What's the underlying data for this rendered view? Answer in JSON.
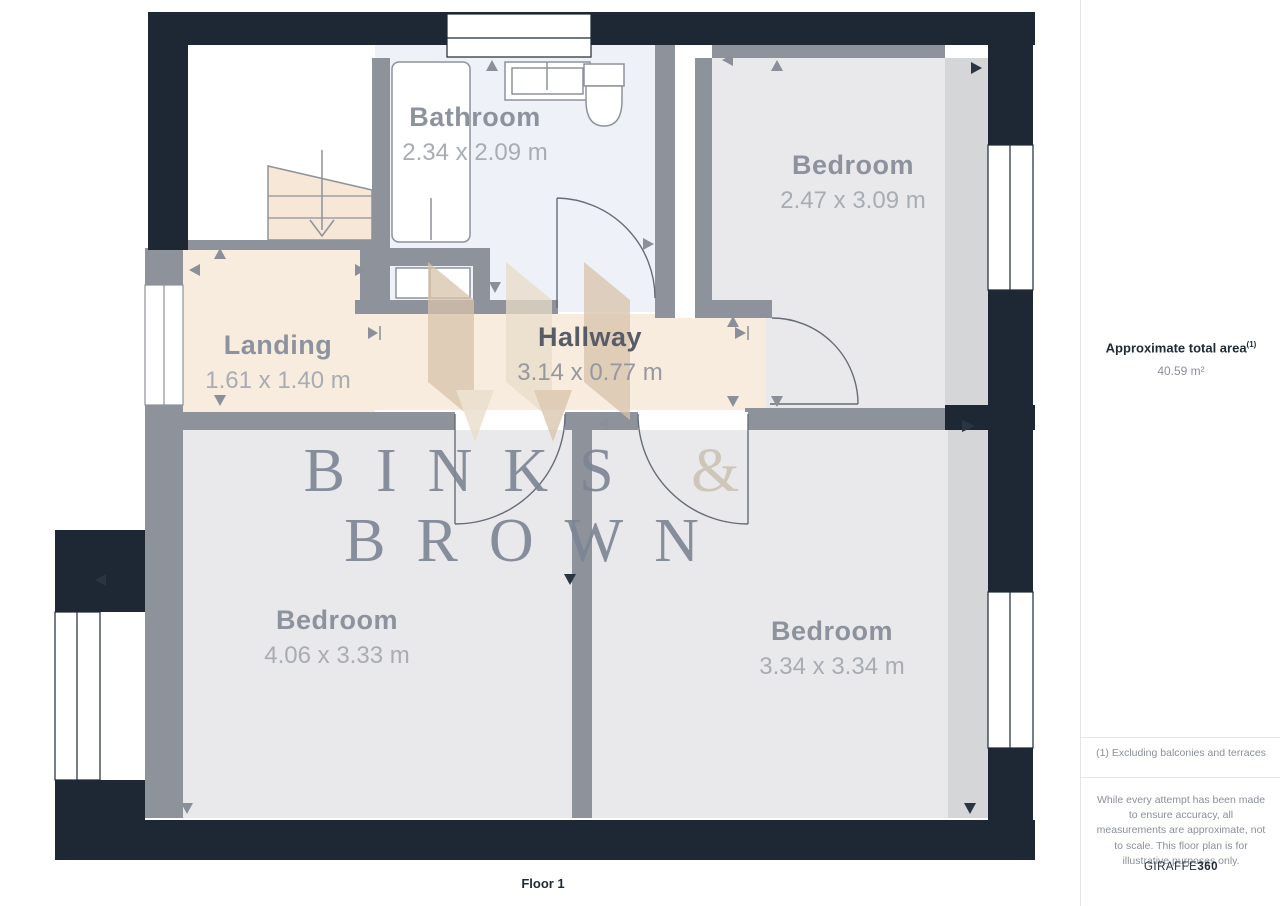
{
  "plan": {
    "floor_label": "Floor 1",
    "rooms": [
      {
        "name": "Bathroom",
        "dims": "2.34 x 2.09 m"
      },
      {
        "name": "Bedroom",
        "dims": "2.47 x 3.09 m"
      },
      {
        "name": "Landing",
        "dims": "1.61 x 1.40 m"
      },
      {
        "name": "Hallway",
        "dims": "3.14 x 0.77 m"
      },
      {
        "name": "Bedroom",
        "dims": "4.06 x 3.33 m"
      },
      {
        "name": "Bedroom",
        "dims": "3.34 x 3.34 m"
      }
    ],
    "watermark": {
      "line1": "BINKS",
      "amp": "&",
      "line2": "BROWN"
    }
  },
  "sidebar": {
    "area_title": "Approximate total area",
    "area_footnote_marker": "(1)",
    "area_value": "40.59 m²",
    "footnote": "(1) Excluding balconies and terraces",
    "disclaimer": "While every attempt has been made to ensure accuracy, all measurements are approximate, not to scale. This floor plan is for illustrative purposes only.",
    "brand": "GIRAFFE",
    "brand_suffix": "360"
  },
  "palette": {
    "wall_dark": "#1e2835",
    "wall_gray": "#8d929b",
    "floor_gray": "#e9e9eb",
    "floor_beige": "#f8ecdf",
    "floor_bath": "#eef1f8",
    "logo_beige_dark": "#d8c3ab",
    "logo_beige_light": "#e9dcc9",
    "watermark_gray": "#7c8594"
  }
}
